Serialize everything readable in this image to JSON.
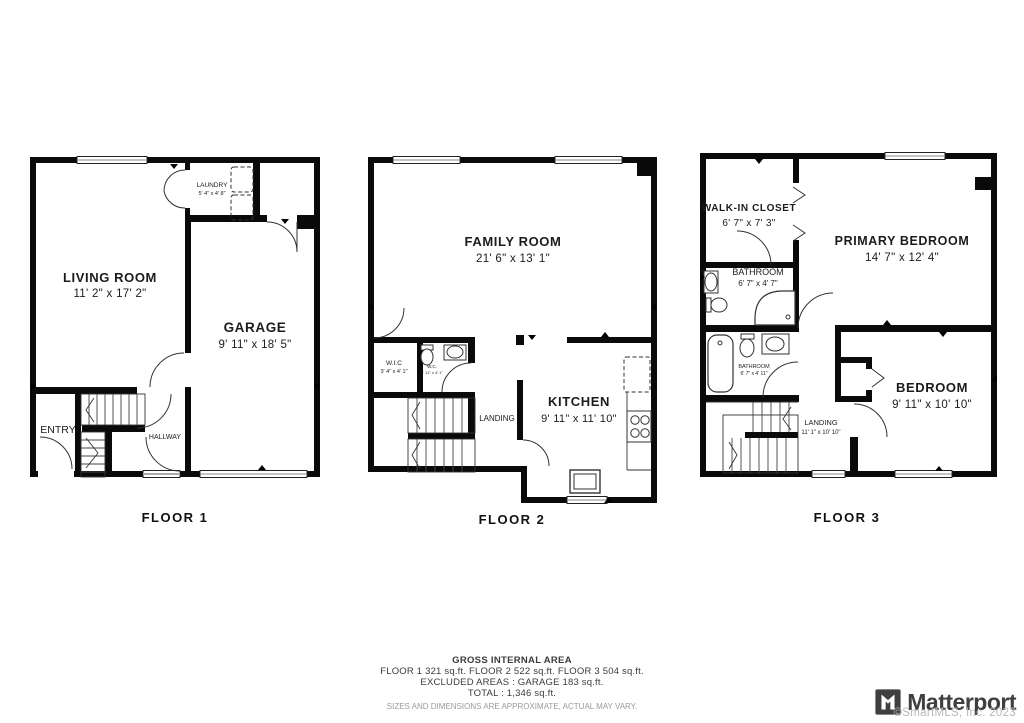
{
  "floors": [
    {
      "label": "FLOOR 1",
      "rooms": {
        "living_room": {
          "name": "LIVING ROOM",
          "dims": "11' 2\" x 17' 2\""
        },
        "garage": {
          "name": "GARAGE",
          "dims": "9' 11\" x 18' 5\""
        },
        "laundry": {
          "name": "LAUNDRY",
          "dims": "5' 4\" x 4' 8\""
        },
        "entry": {
          "name": "ENTRY"
        },
        "hallway": {
          "name": "HALLWAY"
        }
      }
    },
    {
      "label": "FLOOR 2",
      "rooms": {
        "family_room": {
          "name": "FAMILY ROOM",
          "dims": "21' 6\" x 13' 1\""
        },
        "kitchen": {
          "name": "KITCHEN",
          "dims": "9' 11\" x 11' 10\""
        },
        "wic": {
          "name": "W.I.C",
          "dims": "3' 4\" x 4' 1\""
        },
        "wc": {
          "name": "W.C.",
          "dims": "3' 11\" x 4' 1\""
        },
        "landing": {
          "name": "LANDING"
        }
      }
    },
    {
      "label": "FLOOR 3",
      "rooms": {
        "walk_in_closet": {
          "name": "WALK-IN CLOSET",
          "dims": "6' 7\" x 7' 3\""
        },
        "primary_bedroom": {
          "name": "PRIMARY BEDROOM",
          "dims": "14' 7\" x 12' 4\""
        },
        "bathroom_upper": {
          "name": "BATHROOM",
          "dims": "6' 7\" x 4' 7\""
        },
        "bathroom_lower": {
          "name": "BATHROOM",
          "dims": "6' 7\" x 4' 11\""
        },
        "bedroom": {
          "name": "BEDROOM",
          "dims": "9' 11\" x 10' 10\""
        },
        "landing": {
          "name": "LANDING",
          "dims": "11' 1\" x 10' 10\""
        }
      }
    }
  ],
  "summary": {
    "title": "GROSS INTERNAL AREA",
    "floors_line": "FLOOR  1 321 sq.ft.   FLOOR  2 522 sq.ft.   FLOOR 3 504 sq.ft.",
    "excluded_line": "EXCLUDED AREAS :  GARAGE 183 sq.ft.",
    "total_line": "TOTAL :  1,346 sq.ft.",
    "disclaimer": "SIZES AND DIMENSIONS ARE APPROXIMATE, ACTUAL MAY VARY."
  },
  "branding": {
    "logo_text": "Matterport",
    "copyright": "©SmartMLS, Inc.  2023",
    "logo_color": "#3f3f3f",
    "copyright_color": "#b8b8b8"
  }
}
